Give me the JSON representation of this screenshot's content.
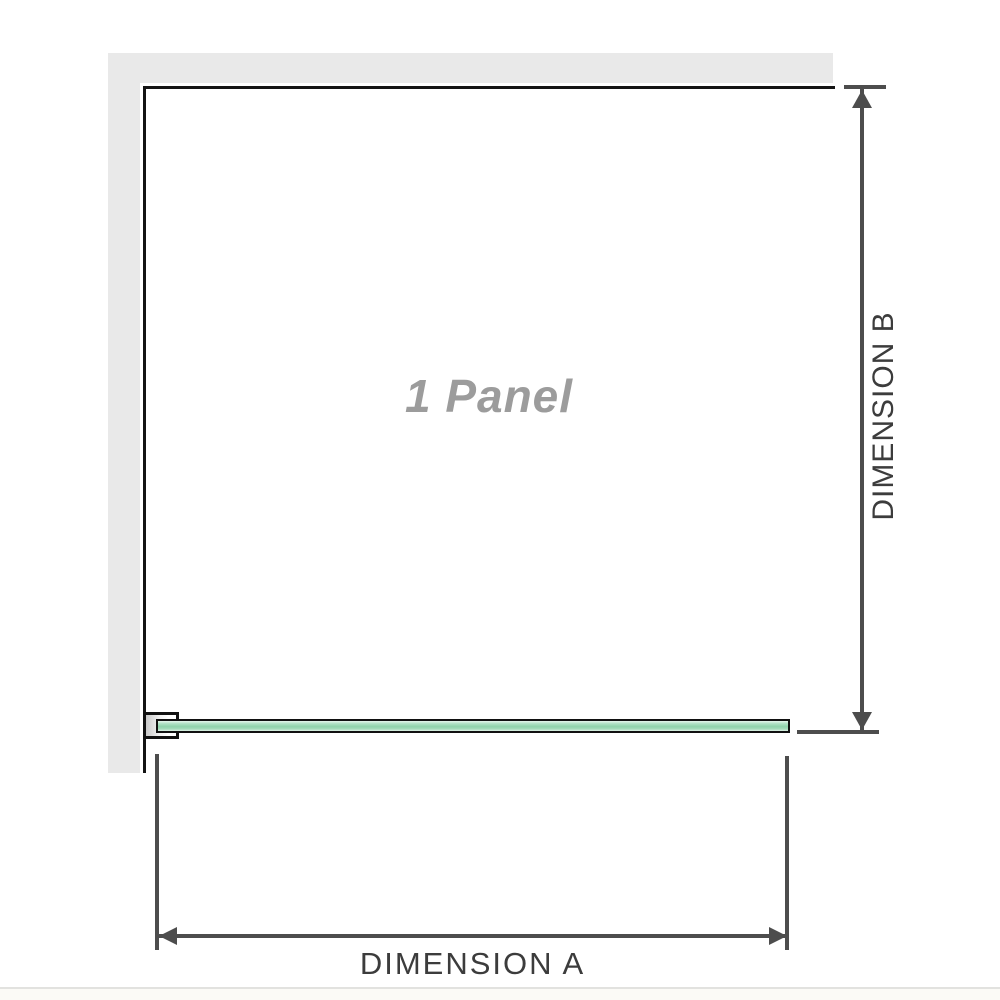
{
  "diagram": {
    "panel_label": "1 Panel",
    "dimensions": {
      "a_label": "DIMENSION A",
      "b_label": "DIMENSION B"
    },
    "colors": {
      "wall_fill": "#e9e9e9",
      "panel_outline": "#141414",
      "glass_green_mid": "#8fd3ab",
      "glass_green_light": "#dff2e7",
      "dimension_line": "#4d4d4d",
      "label_gray": "#9c9c9c",
      "dimension_text": "#3c3c3c"
    }
  }
}
